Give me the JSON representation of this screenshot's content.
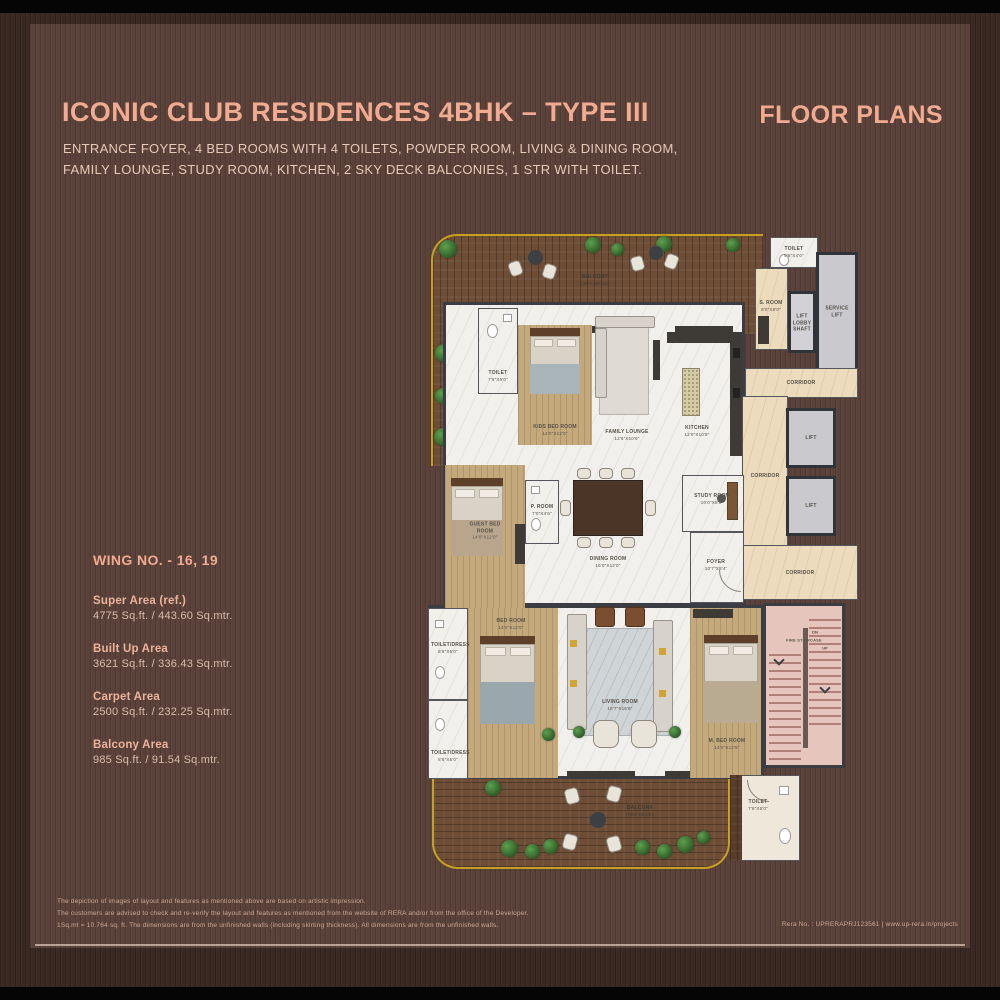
{
  "header": {
    "title": "ICONIC CLUB RESIDENCES 4BHK – TYPE III",
    "subtitle1": "ENTRANCE FOYER, 4 BED ROOMS WITH 4 TOILETS, POWDER ROOM, LIVING & DINING ROOM,",
    "subtitle2": "FAMILY LOUNGE, STUDY ROOM, KITCHEN, 2 SKY DECK BALCONIES, 1 STR WITH TOILET.",
    "right": "FLOOR PLANS"
  },
  "wing": {
    "label": "WING NO. - 16, 19",
    "areas": [
      {
        "name": "Super Area (ref.)",
        "value": "4775 Sq.ft. / 443.60 Sq.mtr."
      },
      {
        "name": "Built Up Area",
        "value": "3621 Sq.ft. / 336.43 Sq.mtr."
      },
      {
        "name": "Carpet Area",
        "value": "2500 Sq.ft. / 232.25 Sq.mtr."
      },
      {
        "name": "Balcony Area",
        "value": "985 Sq.ft. / 91.54 Sq.mtr."
      }
    ]
  },
  "footer": {
    "lines": [
      "The depiction of images of layout and features as mentioned above are based on artistic impression.",
      "The customers are advised to check and re-verify the layout and features as mentioned from the website of RERA and/or from the office of the Developer.",
      "1Sq.mt = 10.764 sq. ft. The dimensions are from the unfinished walls (including skirting thickness). All dimensions are from the unfinished walls."
    ],
    "rera": "Rera No. : UPRERAPRJ123561 | www.up-rera.in/projects"
  },
  "floorplan": {
    "labels": [
      {
        "name": "BALCONY",
        "dims": "(SKY DECK)"
      },
      {
        "name": "TOILET",
        "dims": "7'6\"X5'0\""
      },
      {
        "name": "KIDS BED ROOM",
        "dims": "14'0\"X12'0\""
      },
      {
        "name": "FAMILY LOUNGE",
        "dims": "12'6\"X10'6\""
      },
      {
        "name": "TOILET",
        "dims": "5'6\"X4'0\""
      },
      {
        "name": "S. ROOM",
        "dims": "8'0\"X8'0\""
      },
      {
        "name": "LIFT LOBBY SHAFT",
        "dims": ""
      },
      {
        "name": "SERVICE LIFT",
        "dims": ""
      },
      {
        "name": "CORRIDOR",
        "dims": ""
      },
      {
        "name": "KITCHEN",
        "dims": "12'0\"X10'8\""
      },
      {
        "name": "LIFT",
        "dims": ""
      },
      {
        "name": "LIFT",
        "dims": ""
      },
      {
        "name": "CORRIDOR",
        "dims": ""
      },
      {
        "name": "STUDY ROOM",
        "dims": "10'0\"X8'0\""
      },
      {
        "name": "P. ROOM",
        "dims": "7'0\"X4'6\""
      },
      {
        "name": "GUEST BED ROOM",
        "dims": "14'0\"X12'0\""
      },
      {
        "name": "DINING ROOM",
        "dims": "16'0\"X12'0\""
      },
      {
        "name": "FOYER",
        "dims": "10'7\"X8'4\""
      },
      {
        "name": "CORRIDOR",
        "dims": ""
      },
      {
        "name": "TOILET/DRESS",
        "dims": "8'6\"X5'0\""
      },
      {
        "name": "BED ROOM",
        "dims": "14'0\"X12'0\""
      },
      {
        "name": "LIVING ROOM",
        "dims": "18'7\"X16'8\""
      },
      {
        "name": "M. BED ROOM",
        "dims": "14'0\"X12'6\""
      },
      {
        "name": "FIRE STAIRCASE",
        "dims": ""
      },
      {
        "name": "TOILET/DRESS",
        "dims": "8'6\"X5'0\""
      },
      {
        "name": "BALCONY",
        "dims": "(SKY DECK)"
      },
      {
        "name": "TOILET",
        "dims": "7'6\"X5'0\""
      }
    ],
    "stairs": {
      "dn": "DN",
      "up": "UP"
    }
  },
  "colors": {
    "accent_salmon": "#f2ab90",
    "panel_brown": "#5a423a",
    "frame_brown": "#3a2823",
    "deck_gold_border": "#c8a01f",
    "deck_wood": "#6d4d36",
    "marble_floor": "#f2f0ec",
    "bedroom_wood": "#c4a97d",
    "corridor_marble": "#ecdcbd",
    "lift_grey": "#c9c9ce",
    "stair_pink": "#e6c6bc"
  }
}
